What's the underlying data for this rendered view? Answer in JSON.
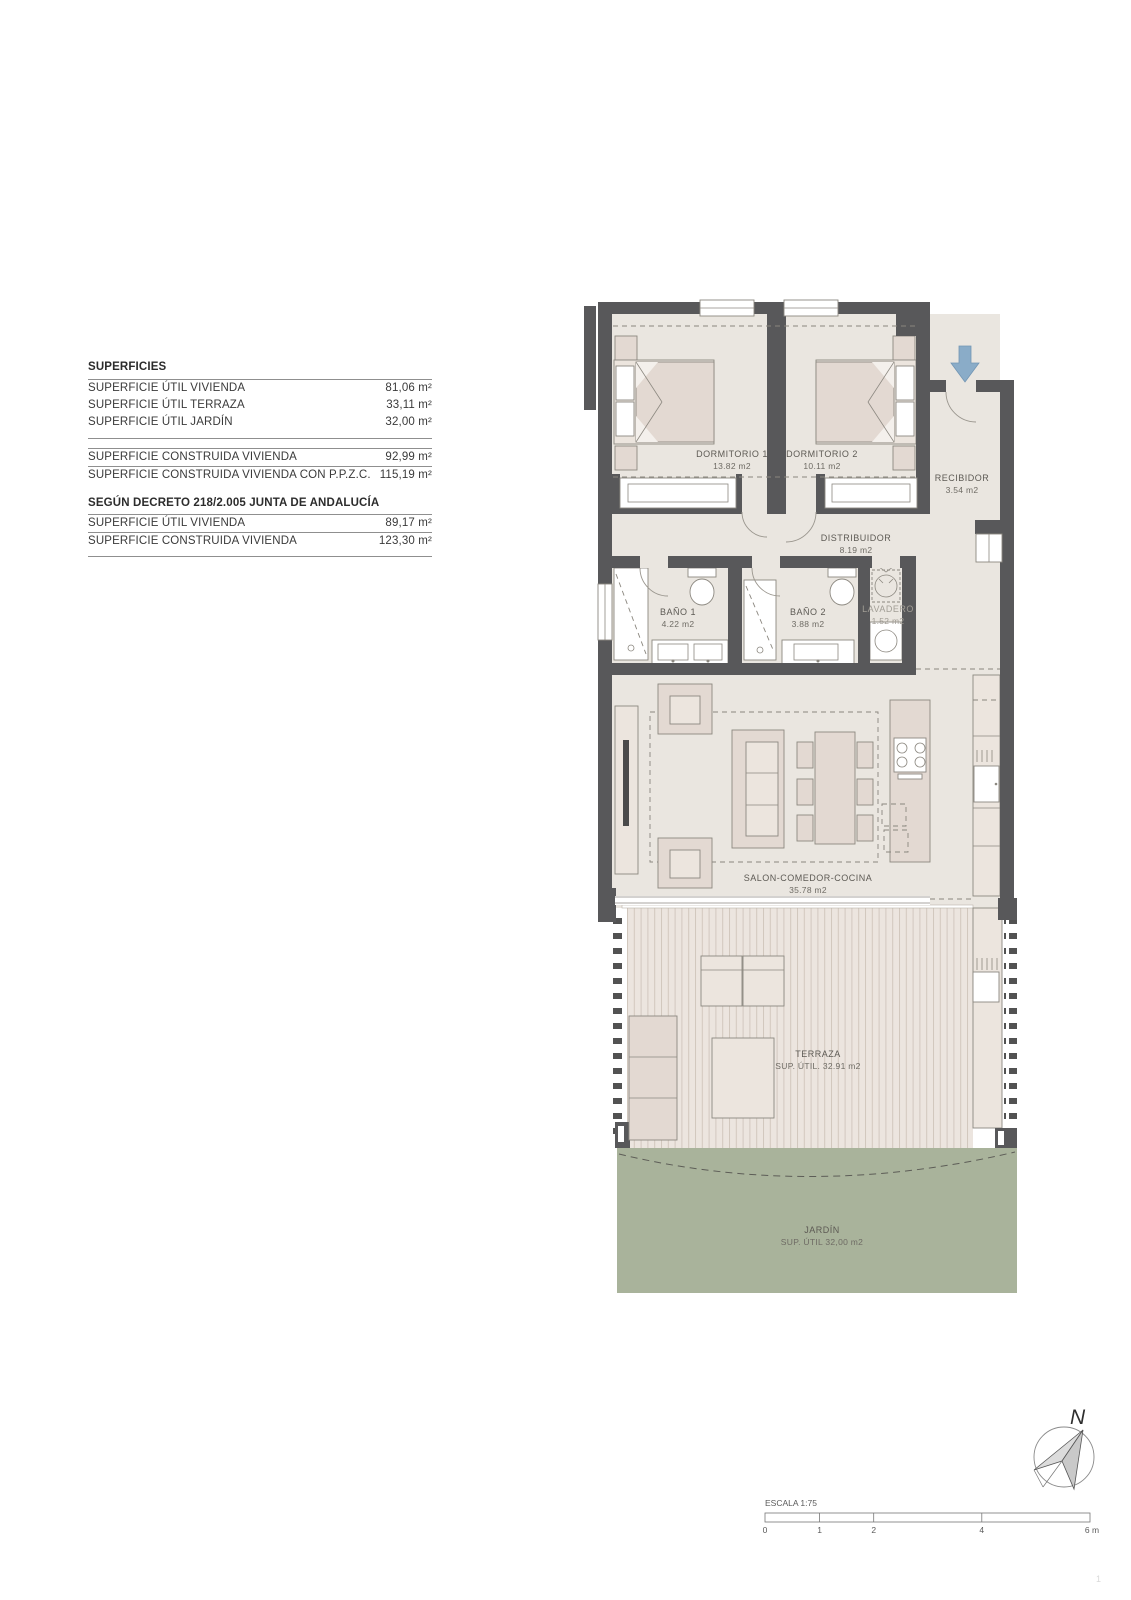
{
  "page": {
    "number": "1"
  },
  "surfaces_table": {
    "title": "SUPERFICIES",
    "rows": [
      {
        "label": "SUPERFICIE ÚTIL VIVIENDA",
        "value": "81,06 m²"
      },
      {
        "label": "SUPERFICIE ÚTIL TERRAZA",
        "value": "33,11 m²"
      },
      {
        "label": "SUPERFICIE ÚTIL JARDÍN",
        "value": "32,00 m²"
      }
    ],
    "rows2": [
      {
        "label": "SUPERFICIE CONSTRUIDA VIVIENDA",
        "value": "92,99 m²"
      },
      {
        "label": "SUPERFICIE CONSTRUIDA VIVIENDA CON P.P.Z.C.",
        "value": "115,19 m²"
      }
    ],
    "subtitle": "SEGÚN DECRETO 218/2.005 JUNTA DE ANDALUCÍA",
    "rows3": [
      {
        "label": "SUPERFICIE ÚTIL VIVIENDA",
        "value": "89,17 m²"
      },
      {
        "label": "SUPERFICIE CONSTRUIDA VIVIENDA",
        "value": "123,30 m²"
      }
    ]
  },
  "plan": {
    "rooms": [
      {
        "name": "DORMITORIO 1",
        "area": "13.82 m2"
      },
      {
        "name": "DORMITORIO 2",
        "area": "10.11 m2"
      },
      {
        "name": "RECIBIDOR",
        "area": "3.54 m2"
      },
      {
        "name": "DISTRIBUIDOR",
        "area": "8.19 m2"
      },
      {
        "name": "BAÑO 1",
        "area": "4.22 m2"
      },
      {
        "name": "BAÑO 2",
        "area": "3.88 m2"
      },
      {
        "name": "LAVADERO",
        "area": "1.52 m2"
      },
      {
        "name": "SALON-COMEDOR-COCINA",
        "area": "35.78 m2"
      },
      {
        "name": "TERRAZA",
        "area": "SUP. ÚTIL. 32.91 m2"
      },
      {
        "name": "JARDÍN",
        "area": "SUP. ÚTIL 32,00 m2"
      }
    ]
  },
  "scale_bar": {
    "label": "ESCALA 1:75",
    "ticks": [
      "0",
      "1",
      "2",
      "4",
      "6 m"
    ]
  },
  "compass": {
    "label": "N"
  },
  "colors": {
    "wall": "#58585a",
    "floor": "#eae6e0",
    "furniture": "#e3d9d2",
    "deck_stripe": "#d2c7be",
    "garden": "#a9b39b",
    "arrow_blue": "#8aacc8"
  }
}
